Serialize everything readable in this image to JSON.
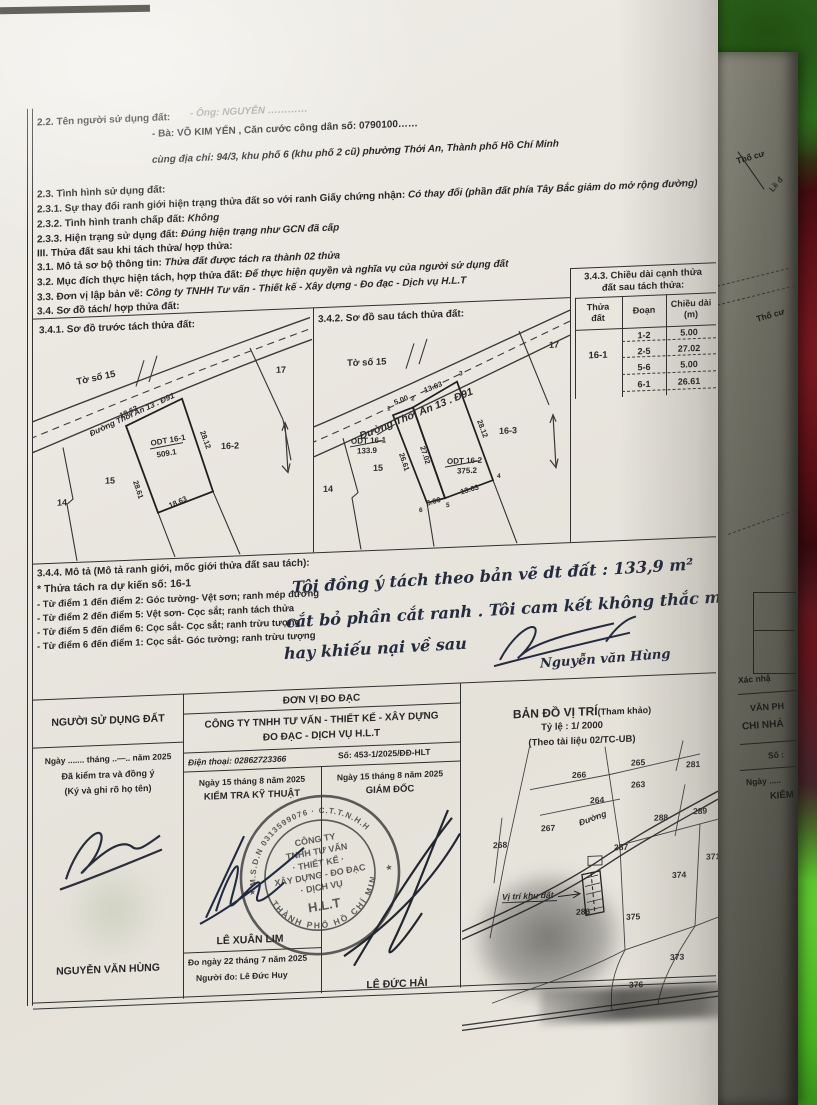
{
  "accent_colors": {
    "paper": "#eae7e0",
    "ink_print": "#272727",
    "ink_pen": "#242b3e",
    "cloth_green": "#46b11f",
    "cloth_red": "#5a1016"
  },
  "info": {
    "s22_label": "2.2. Tên người sử dụng đất:",
    "s22_line1": "- Ông: NGUYỄN …………",
    "s22_line2": "- Bà: VÕ KIM YẾN , Căn cước công dân số: 0790100……",
    "s22_line3": "cùng địa chỉ: 94/3, khu phố 6 (khu phố 2 cũ) phường Thới An, Thành phố Hồ Chí Minh",
    "s23": "2.3. Tình hình sử dụng đất:",
    "s231_label": "2.3.1. Sự thay đổi ranh giới hiện trạng thửa đất so với ranh Giấy chứng nhận:",
    "s231_value": "Có thay đổi (phần đất phía Tây Bắc giảm do mở rộng đường)",
    "s232_label": "2.3.2. Tình hình tranh chấp đất:",
    "s232_value": "Không",
    "s233_label": "2.3.3. Hiện trạng sử dụng đất:",
    "s233_value": "Đúng hiện trạng như GCN đã cấp",
    "s3": "III. Thửa đất sau khi tách thửa/ hợp thửa:",
    "s31_label": "3.1. Mô tả sơ bộ thông tin:",
    "s31_value": "Thửa đất được tách ra thành 02 thửa",
    "s32_label": "3.2. Mục đích thực hiện tách, hợp thửa đất:",
    "s32_value": "Để thực hiện quyền và nghĩa vụ của người sử dụng đất",
    "s33_label": "3.3. Đơn vị lập bản vẽ:",
    "s33_value": "Công ty TNHH Tư vấn - Thiết kế - Xây dựng - Đo đạc - Dịch vụ H.L.T",
    "s34": "3.4. Sơ đồ tách/ hợp thửa đất:"
  },
  "sketch_before": {
    "title": "3.4.1. Sơ đồ trước tách thửa đất:",
    "sheet": "Tờ số 15",
    "road": "Đường Thới An 13 . Đ91",
    "parcel_label": "ODT 16-1",
    "parcel_area": "509.1",
    "len_top": "18.63",
    "len_right": "28.12",
    "len_bottom": "18.63",
    "len_left": "28.61",
    "n17": "17",
    "n162": "16-2",
    "n15": "15",
    "n14": "14"
  },
  "sketch_after": {
    "title": "3.4.2. Sơ đồ sau tách thửa đất:",
    "sheet": "Tờ số 15",
    "road": "Đường Thới An 13 . Đ91",
    "p1_label": "ODT 16-1",
    "p1_area": "133.9",
    "p2_label": "ODT 16-2",
    "p2_area": "375.2",
    "d12": "5.00",
    "d23": "13.63",
    "d34": "28.12",
    "d45": "13.63",
    "d65": "5.00",
    "d25": "27.02",
    "d16": "26.61",
    "pt1": "1",
    "pt2": "2",
    "pt3": "3",
    "pt4": "4",
    "pt5": "5",
    "pt6": "6",
    "n17": "17",
    "n163": "16-3",
    "n15": "15",
    "n14": "14"
  },
  "table343": {
    "title1": "3.4.3. Chiều dài cạnh thửa",
    "title2": "đất sau tách thửa:",
    "col1a": "Thửa",
    "col1b": "đất",
    "col2": "Đoạn",
    "col3a": "Chiều dài",
    "col3b": "(m)",
    "parcel": "16-1",
    "rows": [
      {
        "seg": "1-2",
        "len": "5.00"
      },
      {
        "seg": "2-5",
        "len": "27.02"
      },
      {
        "seg": "5-6",
        "len": "5.00"
      },
      {
        "seg": "6-1",
        "len": "26.61"
      }
    ]
  },
  "s344": {
    "title": "3.4.4. Mô tả (Mô tả ranh giới, mốc giới thửa đất sau tách):",
    "subtitle": "* Thửa tách ra dự kiến số: 16-1",
    "b1": "- Từ điểm 1 đến điểm 2: Góc tường- Vệt sơn; ranh mép đường",
    "b2": "- Từ điểm 2 đến điểm 5: Vệt sơn- Cọc sắt; ranh tách thửa",
    "b3": "- Từ điểm 5 đến điểm 6: Cọc sắt- Cọc sắt; ranh trừu tượng",
    "b4": "- Từ điểm 6 đến điểm 1: Cọc sắt- Góc tường; ranh trừu tượng"
  },
  "hand_note": {
    "line1": "Tôi đồng ý tách theo bản vẽ  dt đất : 133,9 m²",
    "line2": "cắt bỏ phần cắt ranh . Tôi cam kết không thắc mắc",
    "line3": "hay khiếu nại về sau",
    "signer": "Nguyễn văn Hùng"
  },
  "footer": {
    "left": {
      "title": "NGƯỜI SỬ DỤNG ĐẤT",
      "date_line": "Ngày ....... tháng ..—.. năm 2025",
      "line2": "Đã kiểm tra và đồng ý",
      "line3": "(Ký và ghi rõ họ tên)",
      "name": "NGUYỄN VĂN HÙNG"
    },
    "mid": {
      "unit_header": "ĐƠN VỊ ĐO ĐẠC",
      "company1": "CÔNG TY TNHH TƯ VẤN - THIẾT KẾ - XÂY DỰNG",
      "company2": "ĐO ĐẠC - DỊCH VỤ H.L.T",
      "phone": "Điện thoại: 02862723366",
      "doc_no": "Số: 453-1/2025/ĐĐ-HLT",
      "date1": "Ngày 15 tháng 8 năm 2025",
      "role1": "KIỂM TRA KỸ THUẬT",
      "date2": "Ngày 15 tháng 8 năm 2025",
      "role2": "GIÁM ĐỐC",
      "name1": "LÊ XUÂN LIM",
      "measure_date": "Đo ngày 22 tháng 7 năm 2025",
      "measurer": "Người đo: Lê Đức Huy",
      "name2": "LÊ ĐỨC HẢI"
    },
    "stamp": {
      "arc_top": "M.S.D.N  0313599076 · C.T.T.N.H.H",
      "arc_bottom": "THÀNH PHỐ HỒ CHÍ MINH",
      "l1": "CÔNG TY",
      "l2": "TNHH TƯ VẤN",
      "l3": "· THIẾT KẾ ·",
      "l4": "XÂY DỰNG - ĐO ĐẠC",
      "l5": "· DỊCH VỤ",
      "l6": "H.L.T",
      "star_left": "★",
      "star_right": "★"
    }
  },
  "map": {
    "title": "BẢN ĐỒ VỊ TRÍ",
    "title_suffix": "(Tham khảo)",
    "scale": "Tỷ lệ  :  1/ 2000",
    "source": "(Theo tài liệu 02/TC-UB)",
    "road_label": "Đường",
    "target_label": "Vị trí khu đất",
    "parcels": [
      "266",
      "265",
      "281",
      "263",
      "264",
      "288",
      "289",
      "267",
      "268",
      "287",
      "286",
      "375",
      "374",
      "371",
      "373",
      "376"
    ]
  },
  "side_page": {
    "t1": "Thổ cư",
    "t2": "Lề đ",
    "t3": "Thổ cư",
    "t4": "Xác nhậ",
    "t5": "VĂN PH",
    "t6": "CHI NHÁ",
    "t7": "Số :",
    "t8": "Ngày .....",
    "t9": "KIỂM"
  }
}
